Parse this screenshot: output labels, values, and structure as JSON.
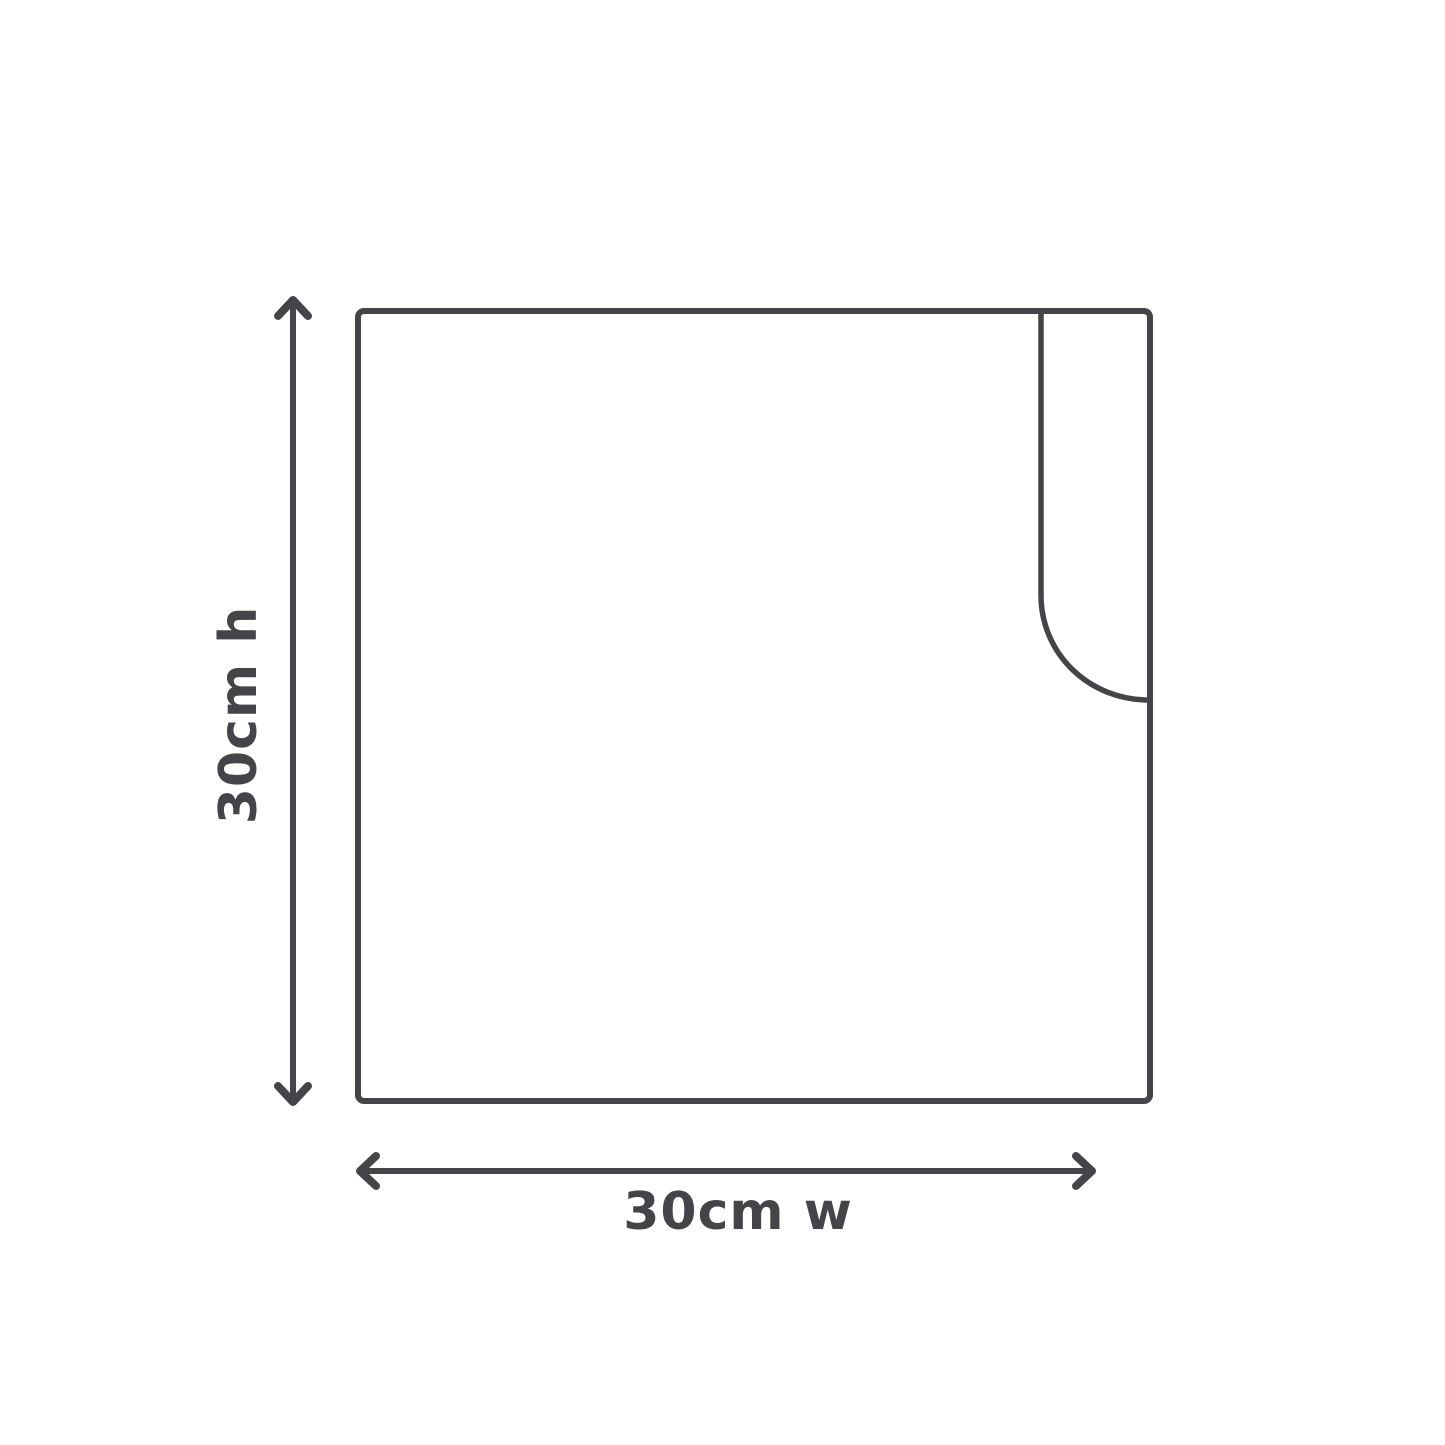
{
  "diagram": {
    "type": "product-dimension-diagram",
    "shape": "square panel with rounded corner-flap cutout at top right",
    "height_label": "30cm h",
    "width_label": "30cm w",
    "colors": {
      "line": "#454549",
      "text": "#454549",
      "background": "#ffffff"
    }
  }
}
